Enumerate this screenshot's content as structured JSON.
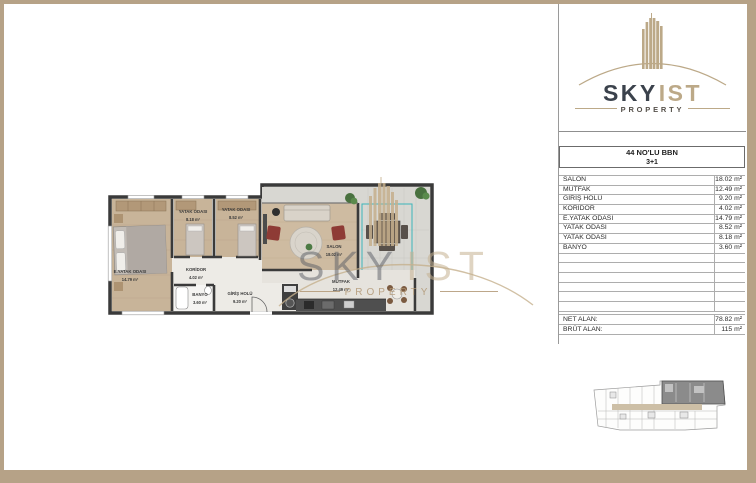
{
  "logo": {
    "sky": "SKY",
    "ist": "IST",
    "property": "PROPERTY"
  },
  "watermark": {
    "sky": "SKY",
    "ist": "IST",
    "property": "PROPERTY"
  },
  "unit": {
    "title": "44 NO'LU BBN",
    "type": "3+1"
  },
  "table": {
    "rows": [
      {
        "label": "SALON",
        "value": "18.02 m²"
      },
      {
        "label": "MUTFAK",
        "value": "12.49 m²"
      },
      {
        "label": "GİRİŞ HOLÜ",
        "value": "9.20 m²"
      },
      {
        "label": "KORİDOR",
        "value": "4.02 m²"
      },
      {
        "label": "E.YATAK ODASI",
        "value": "14.79 m²"
      },
      {
        "label": "YATAK ODASI",
        "value": "8.52 m²"
      },
      {
        "label": "YATAK ODASI",
        "value": "8.18 m²"
      },
      {
        "label": "BANYO",
        "value": "3.60 m²"
      }
    ],
    "summary": [
      {
        "label": "NET ALAN:",
        "value": "78.82 m²"
      },
      {
        "label": "BRÜT ALAN:",
        "value": "115 m²"
      }
    ]
  },
  "plan": {
    "rooms": {
      "eyatak": {
        "label": "E.YATAK ODASI",
        "area": "14.79 m²"
      },
      "yatak_mid": {
        "label": "YATAK ODASI",
        "area": "8.18 m²"
      },
      "yatak_right": {
        "label": "YATAK ODASI",
        "area": "8.52 m²"
      },
      "koridor": {
        "label": "KORİDOR",
        "area": "4.02 m²"
      },
      "banyo": {
        "label": "BANYO",
        "area": "3.60 m²"
      },
      "giris": {
        "label": "GİRİŞ HOLÜ",
        "area": "9.20 m²"
      },
      "salon": {
        "label": "SALON",
        "area": "18.02 m²"
      },
      "mutfak": {
        "label": "MUTFAK",
        "area": "12.49 m²"
      }
    }
  },
  "colors": {
    "frame": "#b6a287",
    "tan": "#bca988",
    "logo_dark": "#3b424c",
    "teal": "#3cb6ba"
  }
}
